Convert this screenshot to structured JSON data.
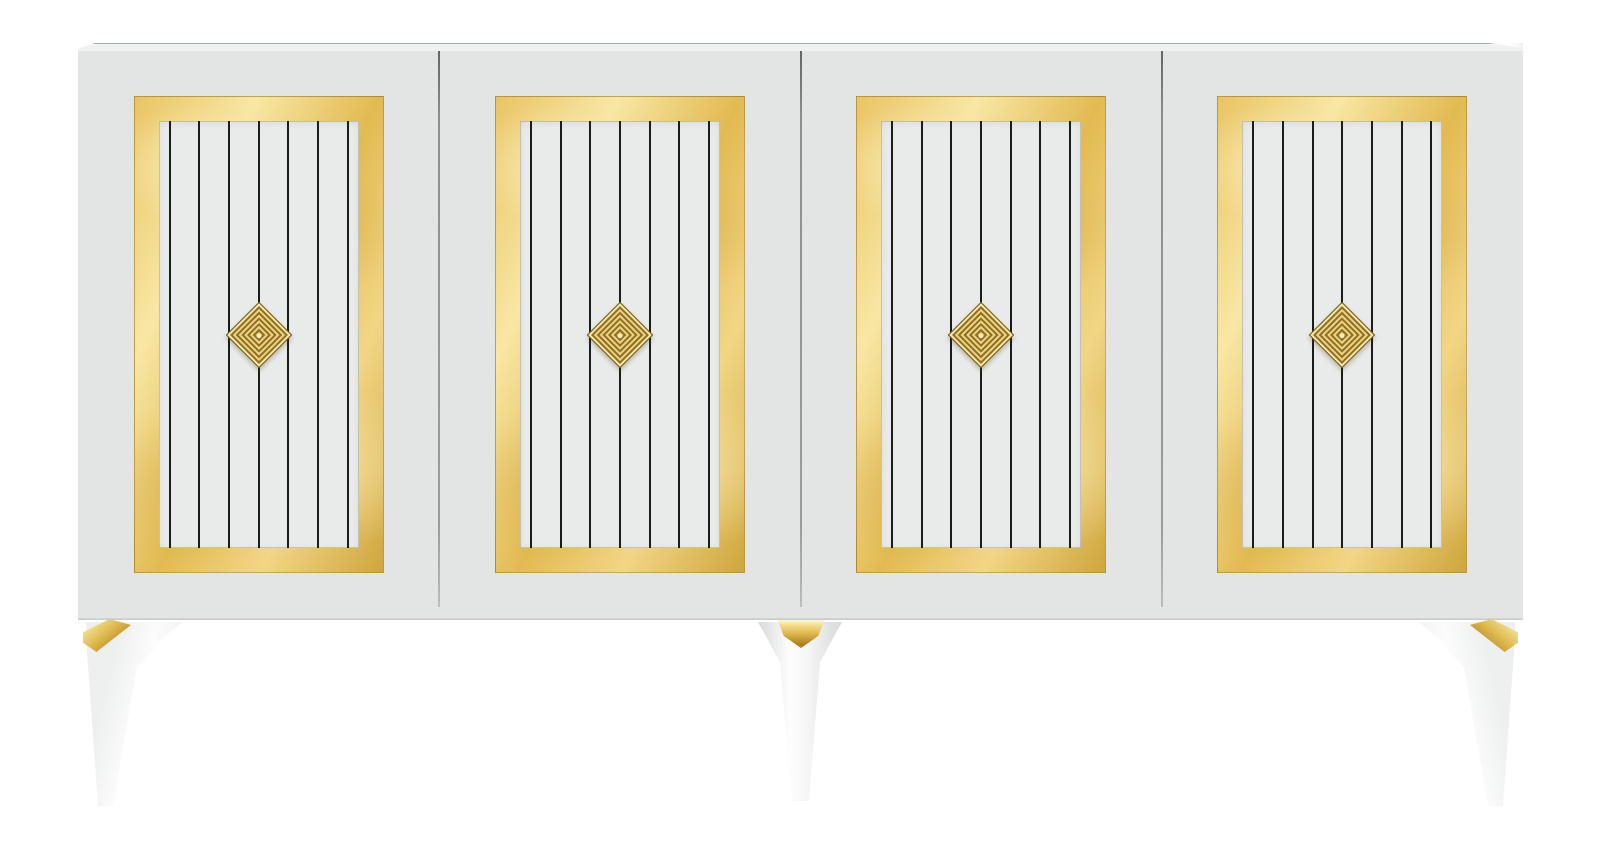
{
  "scene": {
    "alt_text": "White modern sideboard with four doors, each door framed in gold with seven thin black vertical stripes and a concentric gold diamond knob, standing on tapered white legs with gold caps on a plain white background",
    "background_color": "#ffffff"
  },
  "cabinet": {
    "door_count": 4,
    "stripes_per_door": 7,
    "knob_shape": "concentric-diamond",
    "colors": {
      "body": "#e3e5e4",
      "top_surface": "#f0f2f1",
      "top_edge_line": "#aaacab",
      "bottom_edge_line": "#c8cac9",
      "panel": "#e9ebea",
      "stripe": "#1b1d1c",
      "door_gap": "#8d8f8e",
      "gold_frame_base": "#ecc96d",
      "gold_frame_light": "#f8e7a4",
      "gold_frame_deep": "#cfa63e",
      "knob_gold": "#d3b054",
      "knob_ring_light": "#ecd386",
      "knob_ring_dark": "#8f6f22"
    }
  },
  "legs": {
    "visible_count": 3,
    "styles": [
      "angled-front-left",
      "tapered-cone-center",
      "angled-front-right"
    ],
    "colors": {
      "leg_white": "#fbfcfb",
      "leg_shade": "#d8dad9",
      "gold_cap": "#ddb64a"
    }
  }
}
